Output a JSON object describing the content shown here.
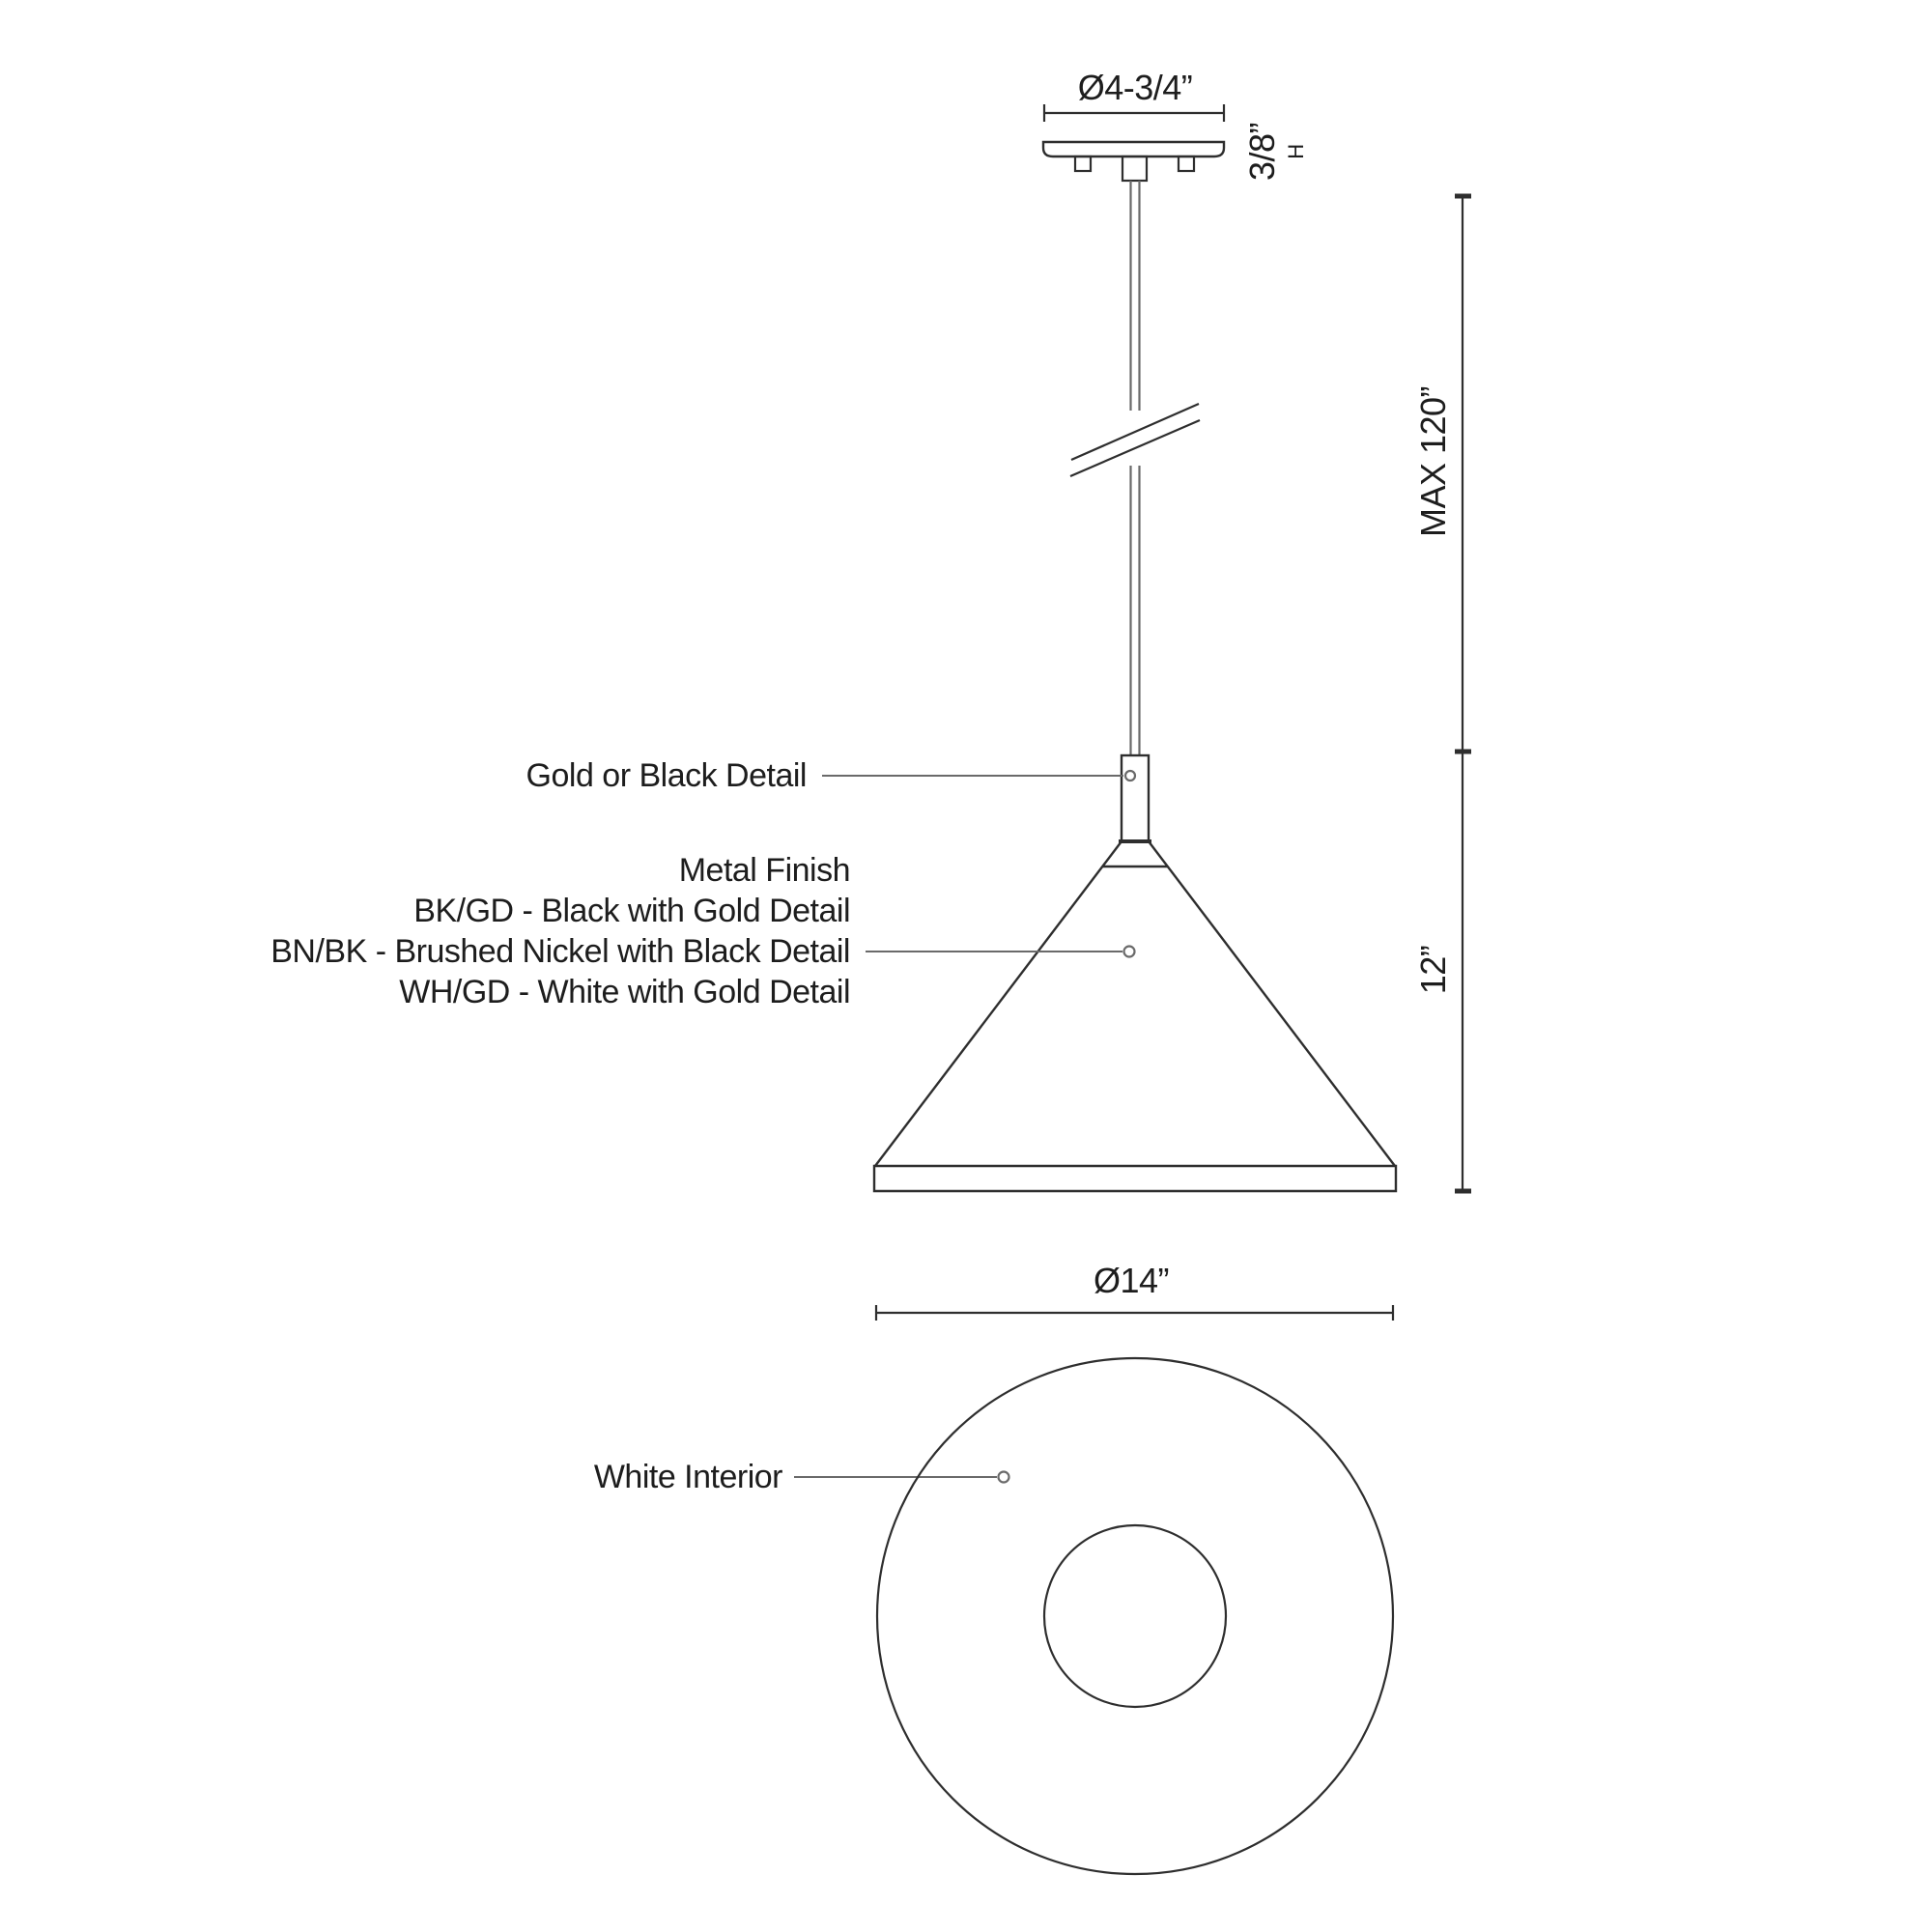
{
  "labels": {
    "canopy_diameter": "Ø4-3/4”",
    "canopy_height": "3/8”",
    "canopy_height_unit": "H",
    "max_height": "MAX 120”",
    "shade_height": "12”",
    "shade_diameter": "Ø14”",
    "detail_callout": "Gold or Black Detail",
    "finish_heading": "Metal Finish",
    "finish_options": [
      "BK/GD - Black with Gold Detail",
      "BN/BK - Brushed Nickel with Black Detail",
      "WH/GD - White with Gold Detail"
    ],
    "interior_callout": "White Interior"
  },
  "colors": {
    "background": "#ffffff",
    "line": "#2e2e2e",
    "leader": "#6a6a6a",
    "text": "#1d1d1d"
  }
}
